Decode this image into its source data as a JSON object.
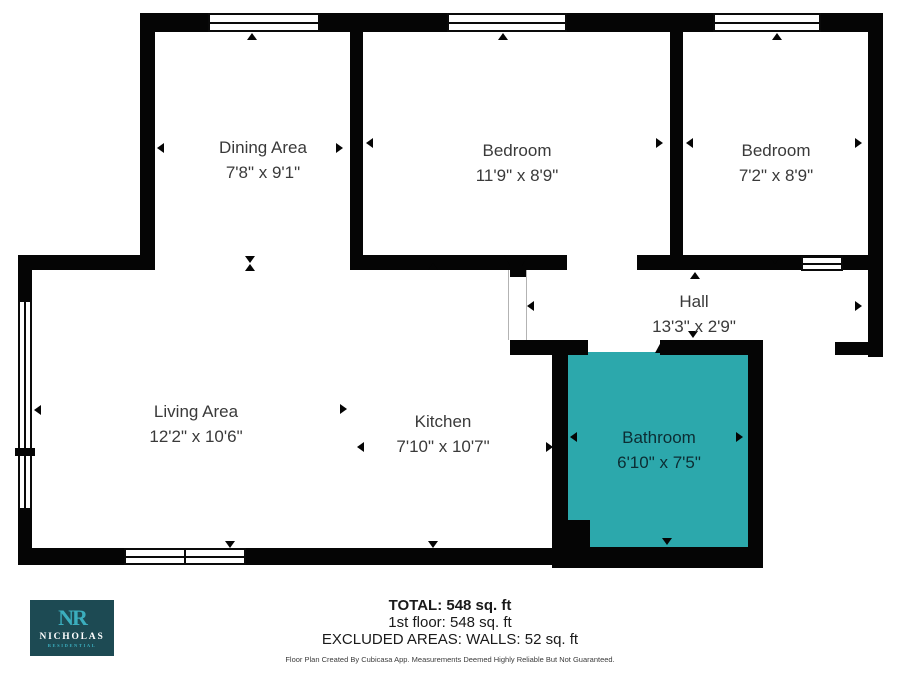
{
  "plan": {
    "rooms": [
      {
        "id": "dining",
        "name": "Dining Area",
        "dims": "7'8\" x 9'1\""
      },
      {
        "id": "bedroom1",
        "name": "Bedroom",
        "dims": "11'9\" x 8'9\""
      },
      {
        "id": "bedroom2",
        "name": "Bedroom",
        "dims": "7'2\" x 8'9\""
      },
      {
        "id": "hall",
        "name": "Hall",
        "dims": "13'3\" x 2'9\""
      },
      {
        "id": "living",
        "name": "Living Area",
        "dims": "12'2\" x 10'6\""
      },
      {
        "id": "kitchen",
        "name": "Kitchen",
        "dims": "7'10\" x 10'7\""
      },
      {
        "id": "bathroom",
        "name": "Bathroom",
        "dims": "6'10\" x 7'5\""
      }
    ],
    "colors": {
      "wall": "#050505",
      "bathroom_fill": "#2CA8AC",
      "label_text": "#3a3a3a",
      "bathroom_label_text": "#0c2d33"
    }
  },
  "footer": {
    "total": "TOTAL: 548 sq. ft",
    "floor": "1st floor: 548 sq. ft",
    "excluded": "EXCLUDED AREAS: WALLS: 52 sq. ft",
    "disclaimer": "Floor Plan Created By Cubicasa App. Measurements Deemed Highly Reliable But Not Guaranteed."
  },
  "logo": {
    "monogram": "NR",
    "name": "NICHOLAS",
    "subtitle": "RESIDENTIAL",
    "bg_color": "#1D4A53",
    "accent_color": "#3BAEBE"
  }
}
